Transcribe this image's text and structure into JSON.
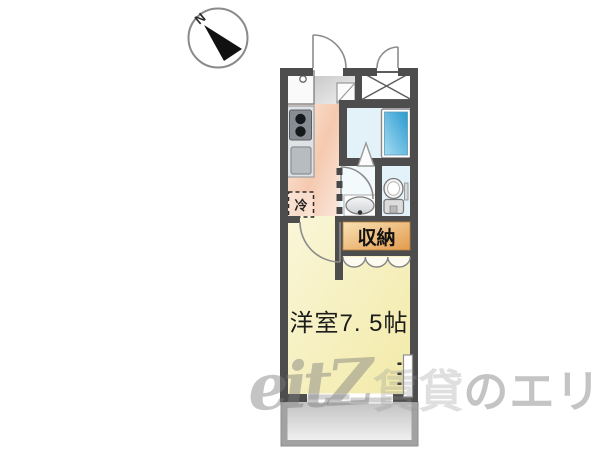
{
  "compass": {
    "label": "N"
  },
  "floorplan": {
    "kitchen": {
      "fridge_label": "冷"
    },
    "storage": {
      "label": "収納"
    },
    "main_room": {
      "label": "洋室7. 5帖"
    }
  },
  "watermark": {
    "logo": "eitZ",
    "middle": "賃貸",
    "rest": "のエリッツ"
  },
  "colors": {
    "wall": "#4d4d4d",
    "kitchen_floor": "#f5c9ae",
    "entry_floor": "#d2d2d2",
    "bath_floor": "#e3f1f8",
    "bathtub": "#2b9bd0",
    "storage": "#e39b4e",
    "room_floor": "#f6f0ba",
    "balcony": "#c2c2c2",
    "watermark_gray": "#7d7d7d"
  }
}
